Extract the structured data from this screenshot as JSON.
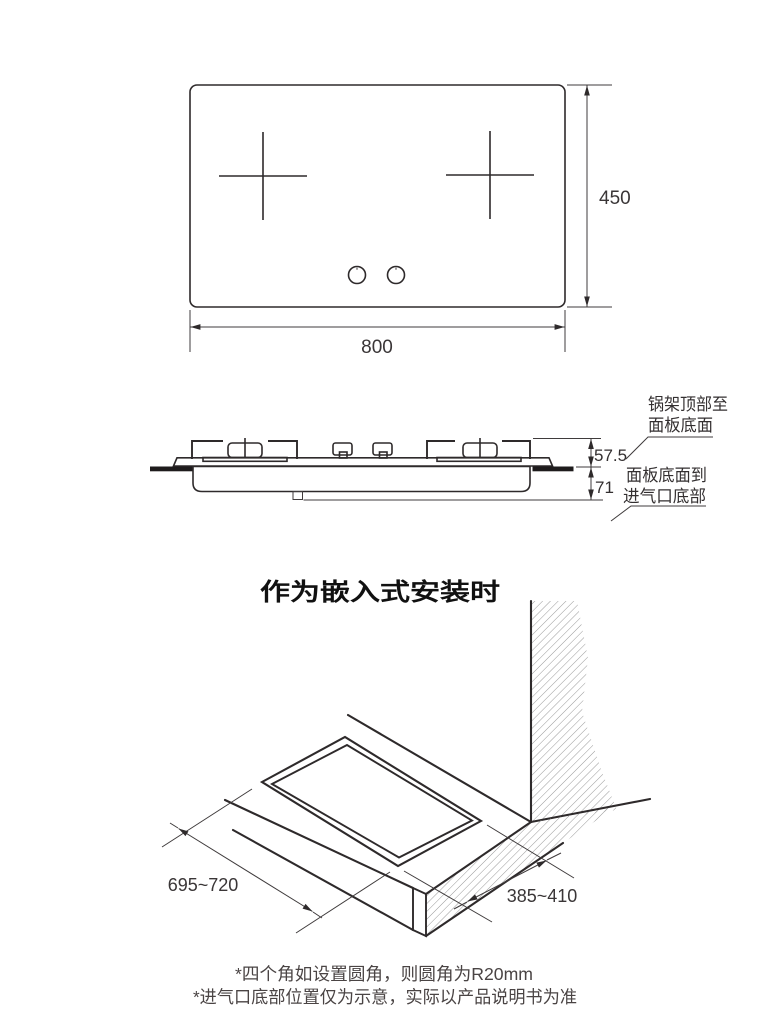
{
  "top_view": {
    "width_dim": "800",
    "height_dim": "450"
  },
  "side_view": {
    "rack_to_panel_dim": "57.5",
    "panel_to_inlet_dim": "71",
    "label_rack_line1": "锅架顶部至",
    "label_rack_line2": "面板底面",
    "label_inlet_line1": "面板底面到",
    "label_inlet_line2": "进气口底部"
  },
  "embedded_view": {
    "title": "作为嵌入式安装时",
    "cutout_length_dim": "695~720",
    "cutout_depth_dim": "385~410"
  },
  "notes": {
    "line1": "*四个角如设置圆角，则圆角为R20mm",
    "line2": "*进气口底部位置仅为示意，实际以产品说明书为准"
  },
  "colors": {
    "line": "#2e2a2b",
    "hatch": "#9a9a9a",
    "note_text": "#4a4444"
  }
}
